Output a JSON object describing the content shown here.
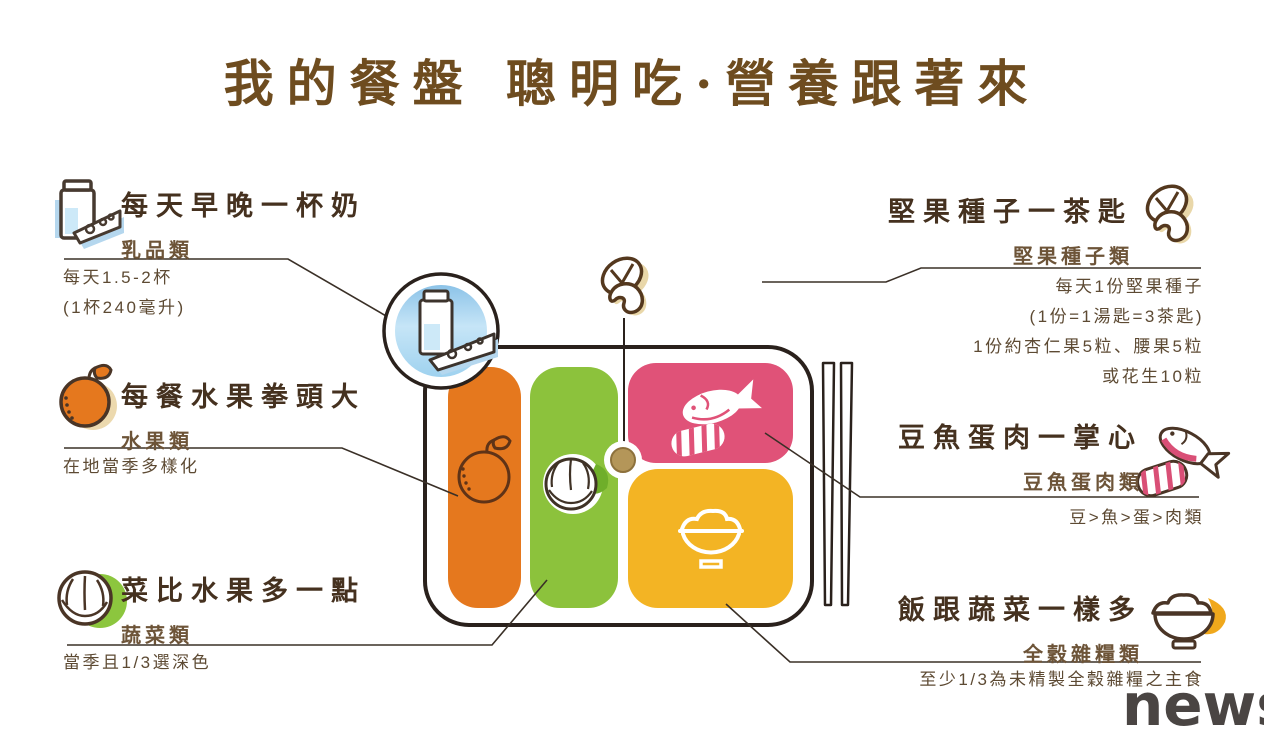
{
  "title": "我的餐盤 聰明吃·營養跟著來",
  "watermark": "news",
  "sections": {
    "dairy": {
      "heading": "每天早晚一杯奶",
      "category": "乳品類",
      "details": [
        "每天1.5-2杯",
        "(1杯240毫升)"
      ],
      "icon": "milk-and-cheese-icon"
    },
    "fruit": {
      "heading": "每餐水果拳頭大",
      "category": "水果類",
      "details": [
        "在地當季多樣化"
      ],
      "icon": "orange-fruit-icon"
    },
    "vegetable": {
      "heading": "菜比水果多一點",
      "category": "蔬菜類",
      "details": [
        "當季且1/3選深色"
      ],
      "icon": "cabbage-icon"
    },
    "nuts": {
      "heading": "堅果種子一茶匙",
      "category": "堅果種子類",
      "details": [
        "每天1份堅果種子",
        "(1份=1湯匙=3茶匙)",
        "1份約杏仁果5粒、腰果5粒",
        "或花生10粒"
      ],
      "icon": "nuts-icon"
    },
    "protein": {
      "heading": "豆魚蛋肉一掌心",
      "category": "豆魚蛋肉類",
      "details": [
        "豆>魚>蛋>肉類"
      ],
      "icon": "fish-and-meat-icon"
    },
    "grains": {
      "heading": "飯跟蔬菜一樣多",
      "category": "全穀雜糧類",
      "details": [
        "至少1/3為未精製全穀雜糧之主食"
      ],
      "icon": "rice-bowl-icon"
    }
  },
  "colors": {
    "title_brown": "#6e4c1f",
    "heading_brown": "#45311f",
    "category_brown": "#6d5438",
    "body_brown": "#5d4a33",
    "fruit_orange": "#e5781e",
    "vegetable_green": "#8cc23c",
    "protein_pink": "#e05278",
    "grains_yellow": "#f3b424",
    "dairy_blue": "#aed5ef",
    "nut_tan": "#e9d7a9",
    "plate_outline": "#2a211c",
    "watermark_gray": "#4a4543"
  }
}
